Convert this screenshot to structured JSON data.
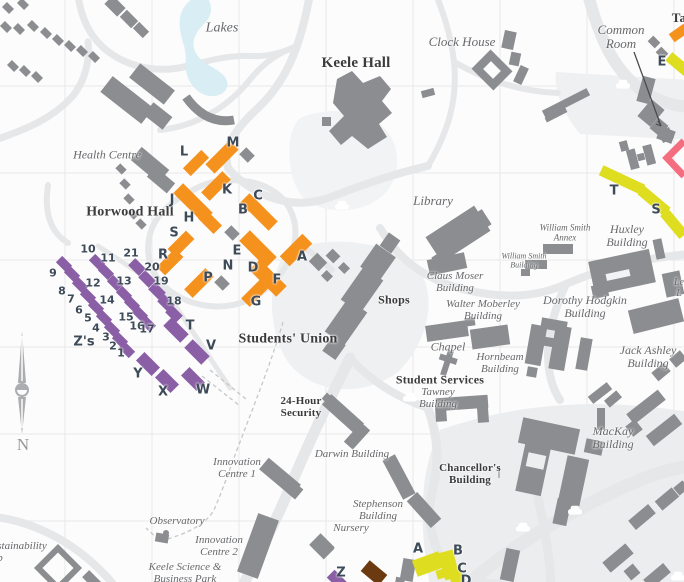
{
  "map_title": "Keele campus map (detail)",
  "colors": {
    "orange": "#F5921E",
    "purple": "#8A5FA6",
    "yellow": "#DFDD1F",
    "pink": "#F56E7F",
    "brown": "#6C3A10",
    "bld": "#8B8D90",
    "road": "#E6E7E9",
    "lake": "#D9EDF4",
    "lbl": "#67686B",
    "lbldark": "#3B3B3D",
    "marker": "#3D4A58"
  },
  "compass": {
    "north_label": "N"
  },
  "labels": [
    {
      "name": "label-lakes",
      "text": "Lakes",
      "x": 222,
      "y": 28,
      "style": "italic",
      "size": 14
    },
    {
      "name": "label-keele-hall",
      "text": "Keele Hall",
      "x": 356,
      "y": 63,
      "style": "bold",
      "size": 15
    },
    {
      "name": "label-clock-house",
      "text": "Clock House",
      "x": 462,
      "y": 42,
      "style": "italic",
      "size": 13
    },
    {
      "name": "label-common-room",
      "lines": [
        "Common",
        "Room"
      ],
      "x": 621,
      "y": 37,
      "style": "italic",
      "size": 13
    },
    {
      "name": "label-health-centre",
      "text": "Health Centre",
      "x": 107,
      "y": 155,
      "style": "italic",
      "size": 12
    },
    {
      "name": "label-horwood-hall",
      "text": "Horwood Hall",
      "x": 130,
      "y": 212,
      "style": "bold",
      "size": 14
    },
    {
      "name": "label-library",
      "text": "Library",
      "x": 433,
      "y": 201,
      "style": "italic",
      "size": 13
    },
    {
      "name": "label-william-smith-annex",
      "lines": [
        "William Smith",
        "Annex"
      ],
      "x": 565,
      "y": 233,
      "style": "italic",
      "size": 9
    },
    {
      "name": "label-huxley-building",
      "lines": [
        "Huxley",
        "Building"
      ],
      "x": 627,
      "y": 236,
      "style": "italic",
      "size": 12
    },
    {
      "name": "label-william-smith-building",
      "lines": [
        "William Smith",
        "Building"
      ],
      "x": 524,
      "y": 261,
      "style": "italic",
      "size": 8
    },
    {
      "name": "label-claus-moser-building",
      "lines": [
        "Claus Moser",
        "Building"
      ],
      "x": 455,
      "y": 283,
      "style": "italic",
      "size": 11
    },
    {
      "name": "label-dorothy-hodgkin-building",
      "lines": [
        "Dorothy Hodgkin",
        "Building"
      ],
      "x": 585,
      "y": 307,
      "style": "italic",
      "size": 12
    },
    {
      "name": "label-walter-moberley-building",
      "lines": [
        "Walter Moberley",
        "Building"
      ],
      "x": 483,
      "y": 311,
      "style": "italic",
      "size": 11
    },
    {
      "name": "label-shops",
      "text": "Shops",
      "x": 394,
      "y": 300,
      "style": "bold",
      "size": 12
    },
    {
      "name": "label-jack-ashley-building",
      "lines": [
        "Jack Ashley",
        "Building"
      ],
      "x": 648,
      "y": 357,
      "style": "italic",
      "size": 12
    },
    {
      "name": "label-chapel",
      "text": "Chapel",
      "x": 448,
      "y": 347,
      "style": "italic",
      "size": 12
    },
    {
      "name": "label-hornbeam-building",
      "lines": [
        "Hornbeam",
        "Building"
      ],
      "x": 500,
      "y": 364,
      "style": "italic",
      "size": 11
    },
    {
      "name": "label-students-union",
      "text": "Students' Union",
      "x": 288,
      "y": 339,
      "style": "bold",
      "size": 14
    },
    {
      "name": "label-student-services",
      "text": "Student Services",
      "x": 440,
      "y": 380,
      "style": "bold",
      "size": 12
    },
    {
      "name": "label-tawney-building",
      "lines": [
        "Tawney",
        "Building"
      ],
      "x": 438,
      "y": 399,
      "style": "italic",
      "size": 11
    },
    {
      "name": "label-mackay-building",
      "lines": [
        "MacKay",
        "Building"
      ],
      "x": 613,
      "y": 438,
      "style": "italic",
      "size": 12
    },
    {
      "name": "label-24-hour-security",
      "lines": [
        "24-Hour",
        "Security"
      ],
      "x": 301,
      "y": 408,
      "style": "bold",
      "size": 11
    },
    {
      "name": "label-darwin-building",
      "text": "Darwin Building",
      "x": 352,
      "y": 455,
      "style": "italic",
      "size": 11
    },
    {
      "name": "label-chancellors-building",
      "lines": [
        "Chancellor's",
        "Building"
      ],
      "x": 470,
      "y": 475,
      "style": "bold",
      "size": 11
    },
    {
      "name": "label-innovation-centre-1",
      "lines": [
        "Innovation",
        "Centre 1"
      ],
      "x": 237,
      "y": 469,
      "style": "italic",
      "size": 11
    },
    {
      "name": "label-stephenson-building",
      "lines": [
        "Stephenson",
        "Building"
      ],
      "x": 378,
      "y": 511,
      "style": "italic",
      "size": 11
    },
    {
      "name": "label-observatory",
      "text": "Observatory",
      "x": 177,
      "y": 522,
      "style": "italic",
      "size": 11
    },
    {
      "name": "label-nursery",
      "text": "Nursery",
      "x": 351,
      "y": 529,
      "style": "italic",
      "size": 11
    },
    {
      "name": "label-innovation-centre-2",
      "lines": [
        "Innovation",
        "Centre 2"
      ],
      "x": 219,
      "y": 547,
      "style": "italic",
      "size": 11
    },
    {
      "name": "label-keele-science-business-park",
      "lines": [
        "Keele Science &",
        "Business Park"
      ],
      "x": 185,
      "y": 574,
      "style": "italic",
      "size": 11
    },
    {
      "name": "label-sustainability-partial",
      "lines": [
        "stainability",
        "b"
      ],
      "x": 22,
      "y": 553,
      "style": "italic left",
      "size": 11
    },
    {
      "name": "label-ta-partial",
      "text": "Ta",
      "x": 679,
      "y": 18,
      "style": "bold",
      "size": 13
    },
    {
      "name": "label-le-partial",
      "lines": [
        "Le",
        "L"
      ],
      "x": 679,
      "y": 289,
      "style": "italic",
      "size": 10
    }
  ],
  "markers": [
    {
      "name": "marker-horwood-L",
      "text": "L",
      "x": 184,
      "y": 152,
      "size": 13
    },
    {
      "name": "marker-horwood-M",
      "text": "M",
      "x": 233,
      "y": 143,
      "size": 13
    },
    {
      "name": "marker-horwood-K",
      "text": "K",
      "x": 227,
      "y": 190,
      "size": 13
    },
    {
      "name": "marker-horwood-J",
      "text": "J",
      "x": 172,
      "y": 200,
      "size": 13
    },
    {
      "name": "marker-horwood-H",
      "text": "H",
      "x": 189,
      "y": 218,
      "size": 13
    },
    {
      "name": "marker-horwood-S",
      "text": "S",
      "x": 174,
      "y": 233,
      "size": 13
    },
    {
      "name": "marker-horwood-R",
      "text": "R",
      "x": 163,
      "y": 255,
      "size": 13
    },
    {
      "name": "marker-horwood-C",
      "text": "C",
      "x": 258,
      "y": 196,
      "size": 13
    },
    {
      "name": "marker-horwood-B",
      "text": "B",
      "x": 243,
      "y": 210,
      "size": 13
    },
    {
      "name": "marker-horwood-E",
      "text": "E",
      "x": 237,
      "y": 251,
      "size": 13
    },
    {
      "name": "marker-horwood-N",
      "text": "N",
      "x": 228,
      "y": 266,
      "size": 13
    },
    {
      "name": "marker-horwood-D",
      "text": "D",
      "x": 253,
      "y": 268,
      "size": 13
    },
    {
      "name": "marker-horwood-P",
      "text": "P",
      "x": 208,
      "y": 278,
      "size": 13
    },
    {
      "name": "marker-horwood-F",
      "text": "F",
      "x": 277,
      "y": 280,
      "size": 13
    },
    {
      "name": "marker-horwood-A",
      "text": "A",
      "x": 302,
      "y": 257,
      "size": 13
    },
    {
      "name": "marker-horwood-G",
      "text": "G",
      "x": 256,
      "y": 302,
      "size": 13
    },
    {
      "name": "marker-block-10",
      "text": "10",
      "x": 88,
      "y": 249,
      "size": 11
    },
    {
      "name": "marker-block-11",
      "text": "11",
      "x": 108,
      "y": 258,
      "size": 11
    },
    {
      "name": "marker-block-21",
      "text": "21",
      "x": 131,
      "y": 253,
      "size": 11
    },
    {
      "name": "marker-block-20",
      "text": "20",
      "x": 152,
      "y": 267,
      "size": 11
    },
    {
      "name": "marker-block-19",
      "text": "19",
      "x": 161,
      "y": 281,
      "size": 11
    },
    {
      "name": "marker-block-9",
      "text": "9",
      "x": 53,
      "y": 273,
      "size": 11
    },
    {
      "name": "marker-block-8",
      "text": "8",
      "x": 62,
      "y": 291,
      "size": 11
    },
    {
      "name": "marker-block-12",
      "text": "12",
      "x": 93,
      "y": 283,
      "size": 11
    },
    {
      "name": "marker-block-13",
      "text": "13",
      "x": 124,
      "y": 281,
      "size": 11
    },
    {
      "name": "marker-block-7",
      "text": "7",
      "x": 71,
      "y": 299,
      "size": 11
    },
    {
      "name": "marker-block-6",
      "text": "6",
      "x": 79,
      "y": 310,
      "size": 11
    },
    {
      "name": "marker-block-14",
      "text": "14",
      "x": 107,
      "y": 300,
      "size": 11
    },
    {
      "name": "marker-block-5",
      "text": "5",
      "x": 88,
      "y": 318,
      "size": 11
    },
    {
      "name": "marker-block-4",
      "text": "4",
      "x": 96,
      "y": 328,
      "size": 11
    },
    {
      "name": "marker-block-15",
      "text": "15",
      "x": 126,
      "y": 317,
      "size": 11
    },
    {
      "name": "marker-block-16",
      "text": "16",
      "x": 137,
      "y": 326,
      "size": 11
    },
    {
      "name": "marker-block-17",
      "text": "17",
      "x": 147,
      "y": 329,
      "size": 11
    },
    {
      "name": "marker-block-3",
      "text": "3",
      "x": 106,
      "y": 337,
      "size": 11
    },
    {
      "name": "marker-block-2",
      "text": "2",
      "x": 113,
      "y": 346,
      "size": 11
    },
    {
      "name": "marker-block-1",
      "text": "1",
      "x": 121,
      "y": 353,
      "size": 11
    },
    {
      "name": "marker-block-18",
      "text": "18",
      "x": 174,
      "y": 301,
      "size": 11
    },
    {
      "name": "marker-zs",
      "text": "Z's",
      "x": 84,
      "y": 342,
      "size": 13
    },
    {
      "name": "marker-block-T",
      "text": "T",
      "x": 190,
      "y": 326,
      "size": 13
    },
    {
      "name": "marker-block-V",
      "text": "V",
      "x": 211,
      "y": 346,
      "size": 13
    },
    {
      "name": "marker-block-Y",
      "text": "Y",
      "x": 138,
      "y": 374,
      "size": 13
    },
    {
      "name": "marker-block-X",
      "text": "X",
      "x": 163,
      "y": 392,
      "size": 13
    },
    {
      "name": "marker-block-W",
      "text": "W",
      "x": 203,
      "y": 390,
      "size": 13
    },
    {
      "name": "marker-block-Z",
      "text": "Z",
      "x": 341,
      "y": 573,
      "size": 13
    },
    {
      "name": "marker-east-E",
      "text": "E",
      "x": 662,
      "y": 62,
      "size": 13
    },
    {
      "name": "marker-east-T",
      "text": "T",
      "x": 614,
      "y": 191,
      "size": 13
    },
    {
      "name": "marker-east-S",
      "text": "S",
      "x": 656,
      "y": 210,
      "size": 13
    },
    {
      "name": "marker-south-A",
      "text": "A",
      "x": 418,
      "y": 549,
      "size": 13
    },
    {
      "name": "marker-south-B",
      "text": "B",
      "x": 458,
      "y": 551,
      "size": 13
    },
    {
      "name": "marker-south-C",
      "text": "C",
      "x": 462,
      "y": 569,
      "size": 13
    },
    {
      "name": "marker-south-D",
      "text": "D",
      "x": 466,
      "y": 581,
      "size": 13
    }
  ],
  "cars": [
    {
      "name": "car-icon",
      "x": 332,
      "y": 199
    },
    {
      "name": "car-icon",
      "x": 613,
      "y": 78
    },
    {
      "name": "car-icon",
      "x": 400,
      "y": 391
    },
    {
      "name": "car-icon",
      "x": 513,
      "y": 521
    },
    {
      "name": "car-icon",
      "x": 565,
      "y": 504
    },
    {
      "name": "car-icon",
      "x": 668,
      "y": 570
    }
  ]
}
